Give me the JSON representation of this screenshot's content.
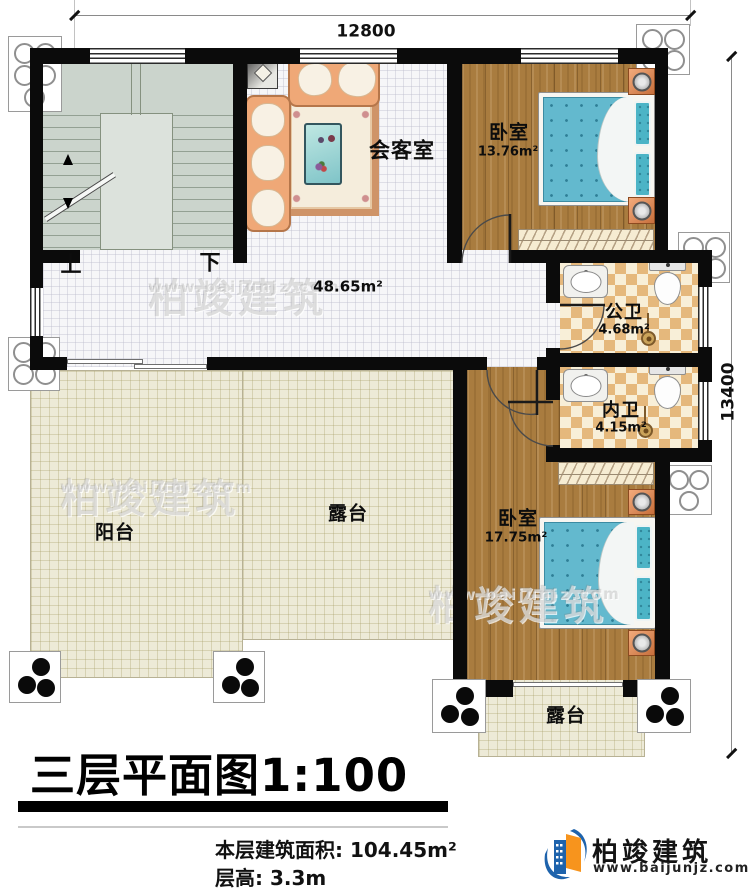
{
  "plan": {
    "dimensions": {
      "width_mm": "12800",
      "height_mm": "13400"
    },
    "stairwell": {
      "up_label": "上",
      "down_label": "下"
    },
    "hall": {
      "area": "48.65m²"
    },
    "reception": {
      "name": "会客室"
    },
    "bedroom_top": {
      "name": "卧室",
      "area": "13.76m²"
    },
    "bathroom_public": {
      "name": "公卫",
      "area": "4.68m²"
    },
    "bathroom_private": {
      "name": "内卫",
      "area": "4.15m²"
    },
    "bedroom_bottom": {
      "name": "卧室",
      "area": "17.75m²"
    },
    "balcony": {
      "name": "阳台"
    },
    "terrace_left": {
      "name": "露台"
    },
    "terrace_bottom": {
      "name": "露台"
    }
  },
  "title_block": {
    "title": "三层平面图1:100",
    "floor_area": "本层建筑面积: 104.45m²",
    "floor_height": "层高: 3.3m"
  },
  "brand": {
    "name": "柏竣建筑",
    "website": "www.baijunjz.com"
  },
  "watermark": {
    "name": "柏竣建筑",
    "website": "www.baijunjz.com"
  },
  "colors": {
    "wall": "#0b0b0b",
    "bed": "#63b9ce",
    "brand_orange": "#f7941d",
    "brand_blue": "#1e63ac",
    "wood": "#a97c3f"
  }
}
